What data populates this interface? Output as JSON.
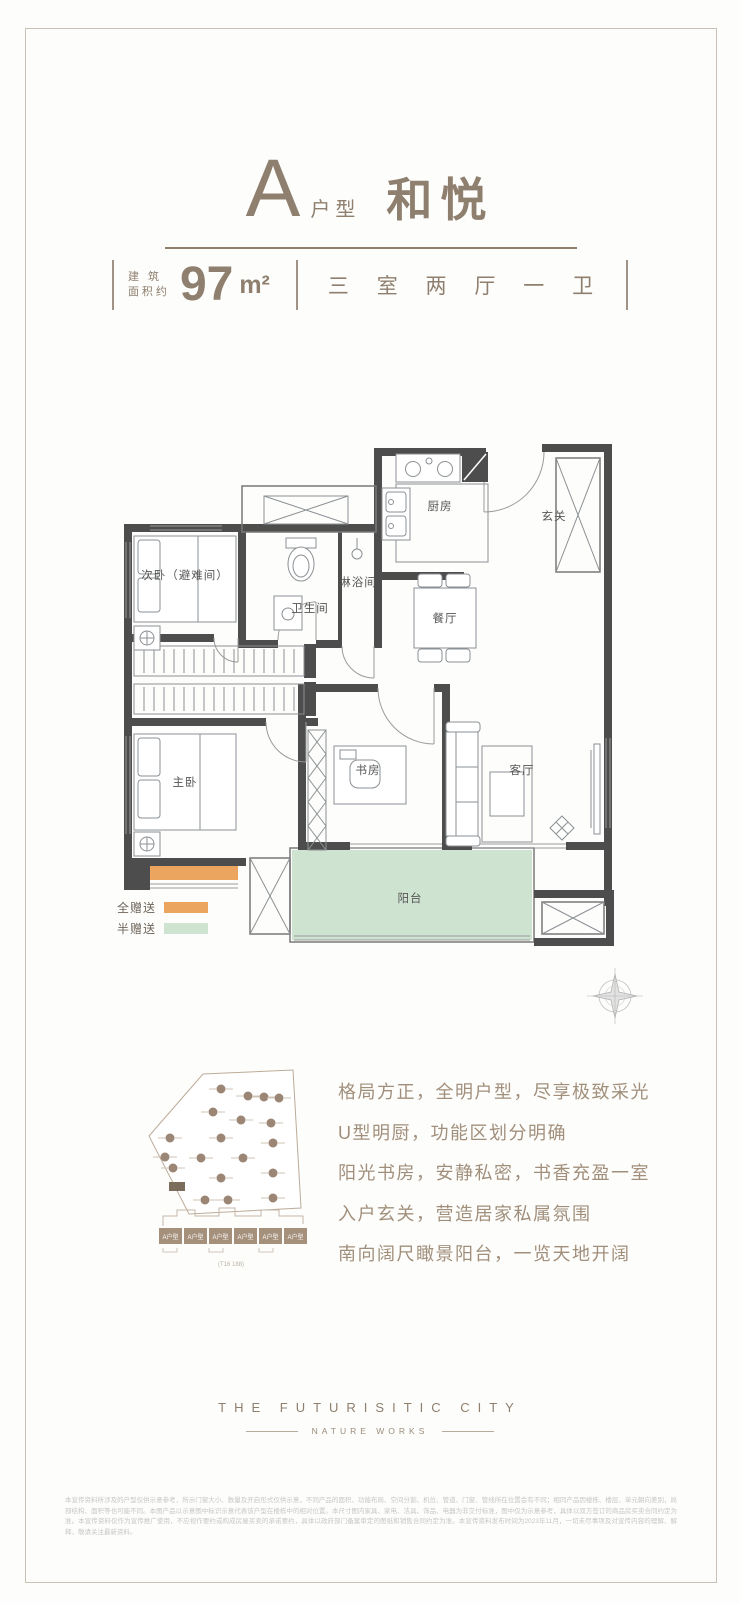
{
  "header": {
    "plan_letter": "A",
    "plan_word": "户型",
    "plan_name": "和悦",
    "area_label_top": "建 筑",
    "area_label_bottom": "面积约",
    "area_number": "97",
    "area_unit": "m²",
    "rooms_spec": "三 室 两 厅 一 卫"
  },
  "floorplan": {
    "rooms": {
      "second_bedroom": "次卧（避难间）",
      "bathroom": "卫生间",
      "shower": "淋浴间",
      "kitchen": "厨房",
      "foyer": "玄关",
      "dining": "餐厅",
      "master_bedroom": "主卧",
      "study": "书房",
      "living": "客厅",
      "balcony": "阳台"
    },
    "colors": {
      "wall": "#4D4D4D",
      "full_gift": "#EBA55E",
      "half_gift": "#CFE3D1"
    },
    "legend": [
      {
        "label": "全赠送"
      },
      {
        "label": "半赠送"
      }
    ]
  },
  "siteplan": {
    "unit_label": "A户型",
    "caption": "(T16 188)"
  },
  "features": [
    "格局方正，全明户型，尽享极致采光",
    "U型明厨，功能区划分明确",
    "阳光书房，安静私密，书香充盈一室",
    "入户玄关，营造居家私属氛围",
    "南向阔尺瞰景阳台，一览天地开阔"
  ],
  "footer": {
    "brand": "THE FUTURISITIC CITY",
    "tagline": "NATURE WORKS"
  },
  "disclaimer": "本宣传资料所涉及的户型仅供示意参考，所示门窗大小、数量及开启形式仅供示意，不同产品的面积、功能布局、空间分割、机位、管道、门窗、管线所在位置会有不同；相同产品因楼栋、楼层、单元朝向差别，局部结构、面积等也可能不同。本图产品以示意图中标识示意代表该户型在楼栋中的相对位置。本尺寸图内家具、家电、洁具、饰品、电器为非交付标准，图中仅为示意参考，具体以双方签订的商品房买卖合同约定为准。本宣传资料仅作为宣传推广使用，不应视作要约或构成房屋买卖的承诺要约，具体以政府部门备案审定的图纸和销售合同约定为准。本宣传资料发布时间为2023年11月，一切未尽事项及对宣传内容的理解、解释，敬请关注最新资料。"
}
